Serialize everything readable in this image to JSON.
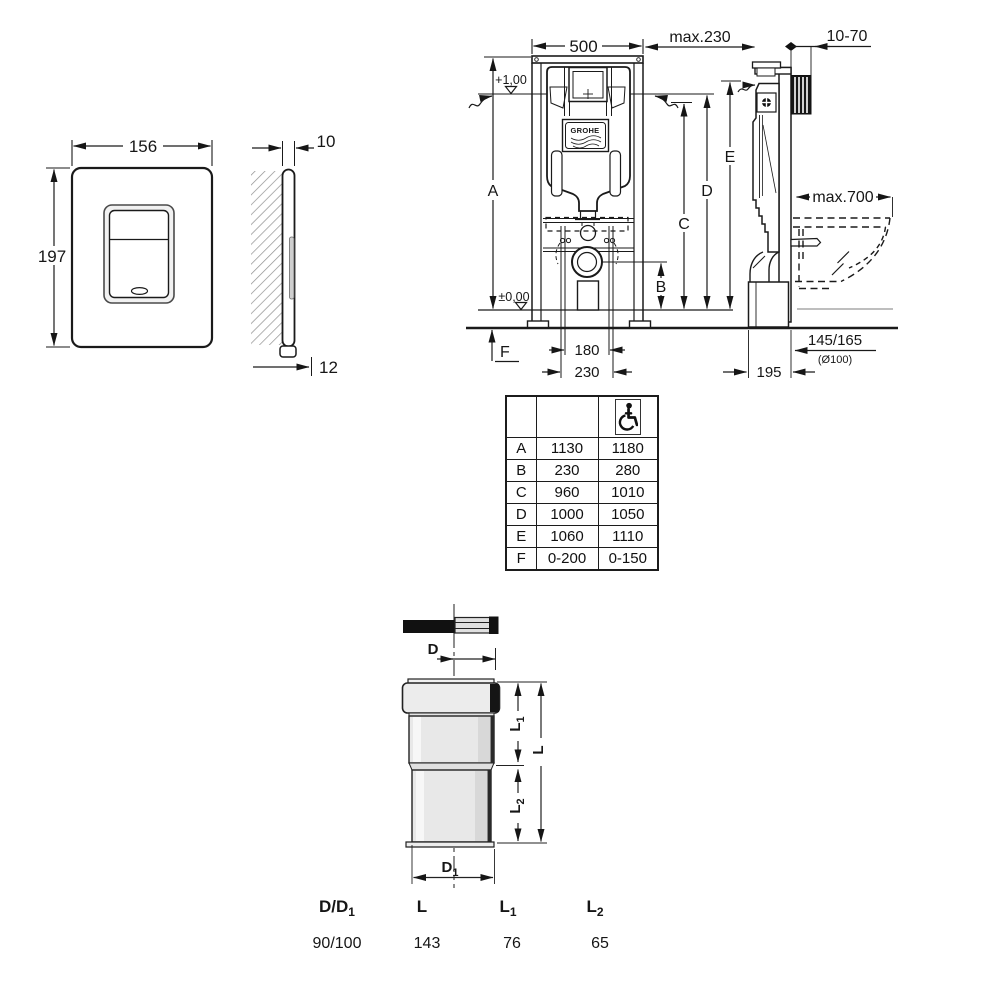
{
  "flush_plate_front": {
    "width": "156",
    "height": "197"
  },
  "flush_plate_side": {
    "thickness": "10",
    "depth": "12"
  },
  "frame_front": {
    "width": "500",
    "level_top": "+1,00",
    "level_floor": "±0,00",
    "dim_a": "A",
    "dim_b": "B",
    "dim_c": "C",
    "dim_d": "D",
    "dim_e": "E",
    "dim_f": "F",
    "bolt_spacing": "180",
    "outlet_spacing": "230",
    "logo": "GROHE"
  },
  "frame_side": {
    "max_depth": "max.230",
    "wall_thickness": "10-70",
    "max_width": "max.700",
    "outlet_height": "145/165",
    "outlet_diameter": "(Ø100)",
    "frame_depth": "195"
  },
  "dimension_table": {
    "rows": [
      {
        "key": "A",
        "standard": "1130",
        "accessible": "1180"
      },
      {
        "key": "B",
        "standard": "230",
        "accessible": "280"
      },
      {
        "key": "C",
        "standard": "960",
        "accessible": "1010"
      },
      {
        "key": "D",
        "standard": "1000",
        "accessible": "1050"
      },
      {
        "key": "E",
        "standard": "1060",
        "accessible": "1110"
      },
      {
        "key": "F",
        "standard": "0-200",
        "accessible": "0-150"
      }
    ]
  },
  "pipe": {
    "dim_d": "D",
    "dim_d1_base": "D",
    "dim_d1_sub": "1",
    "dim_l_base": "L",
    "dim_l1_base": "L",
    "dim_l1_sub": "1",
    "dim_l2_base": "L",
    "dim_l2_sub": "2",
    "table": {
      "col1_base": "D/D",
      "col1_sub": "1",
      "col1_value": "90/100",
      "col2_base": "L",
      "col2_value": "143",
      "col3_base": "L",
      "col3_sub": "1",
      "col3_value": "76",
      "col4_base": "L",
      "col4_sub": "2",
      "col4_value": "65"
    }
  }
}
